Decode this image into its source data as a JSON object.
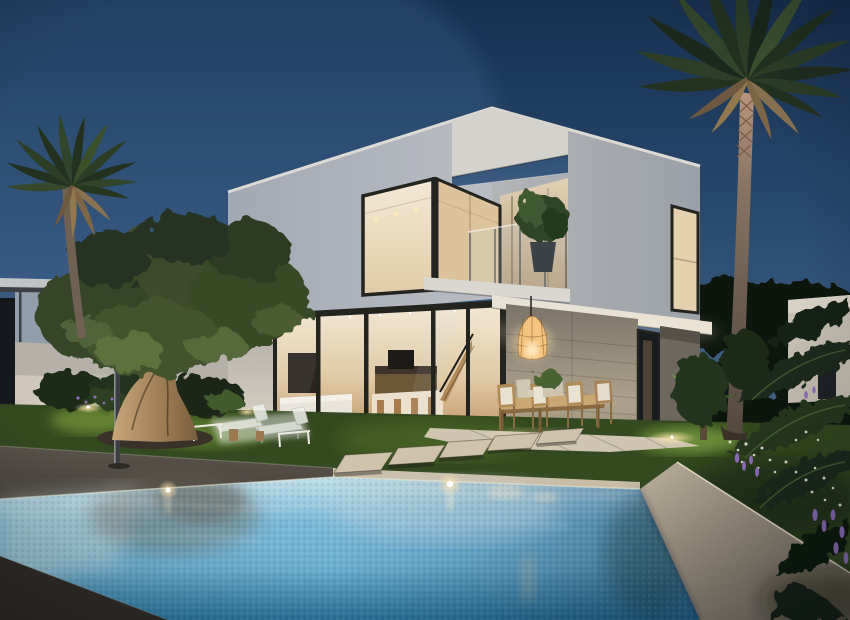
{
  "meta": {
    "type": "architectural-exterior-render",
    "time_of_day": "dusk",
    "description": "Render of a modern two-storey white villa at dusk with illuminated interior, corner glass walls, balcony with potted plant, covered dining terrace with rattan pendant lamp, stone-clad wall, lawn with old olive tree, two palm trees, tropical flowering plants and a mosaic-tiled swimming pool with stepping stones and sun loungers."
  },
  "objects": [
    "dusk sky",
    "white villa",
    "upper-floor corner window",
    "roof frame opening",
    "balcony with potted plant",
    "ground-floor glazing",
    "interior kitchen island and stools",
    "staircase",
    "sofa",
    "stone-clad wall",
    "rattan pendant lamp",
    "outdoor dining table and chairs",
    "covered terrace",
    "lawn",
    "garden uplights",
    "stepping stones",
    "sun loungers",
    "side tables",
    "outdoor shower",
    "olive tree",
    "left palm tree",
    "right palm tree",
    "small fan palm",
    "tropical leaves",
    "white flowers",
    "purple flowers",
    "swimming pool",
    "pool mosaic water",
    "pool coping",
    "dark pool deck",
    "neighbouring house left",
    "neighbouring house right",
    "background trees"
  ],
  "palette": {
    "sky_top": "#16304f",
    "sky_mid": "#2a4a70",
    "sky_horizon": "#48688e",
    "wall_left": "#b9bcc2",
    "wall_right": "#b3b5b6",
    "fascia": "#dcdad4",
    "frame": "#24241f",
    "interior_bright": "#f4e9d6",
    "interior_warm": "#e0c9a5",
    "interior_deep": "#c29a6e",
    "stone_top": "#8f8678",
    "stone_lit": "#cbbda4",
    "terrace": "#cfc5b0",
    "grass": "#33491f",
    "grass_lit": "#7fa13d",
    "canopy": "#3c4c2a",
    "canopy_dark": "#263120",
    "canopy_lit": "#5d6f3e",
    "olive_trunk_lit": "#c9a87c",
    "olive_trunk_dark": "#6b5438",
    "palm_dark": "#22321f",
    "palm_mid": "#35492a",
    "palm_dried": "#8a7150",
    "palm_trunk": "#6f6052",
    "palm_trunk_woven": "#b89680",
    "water_far": "#c3dfe9",
    "water_mid": "#6fb3d4",
    "water_deep": "#2d7ca6",
    "coping": "#c9bda6",
    "coping_shade": "#8a8072",
    "deck": "#4a443d",
    "deck_near": "#3b3631",
    "bg_tree": "#0d1711",
    "neighbor_wall": "#99a2ae",
    "flower_purple": "#8f6fc0",
    "flower_white": "#e9e7d8",
    "pendant": "#f2c47e",
    "glow": "#ffe3ae"
  }
}
